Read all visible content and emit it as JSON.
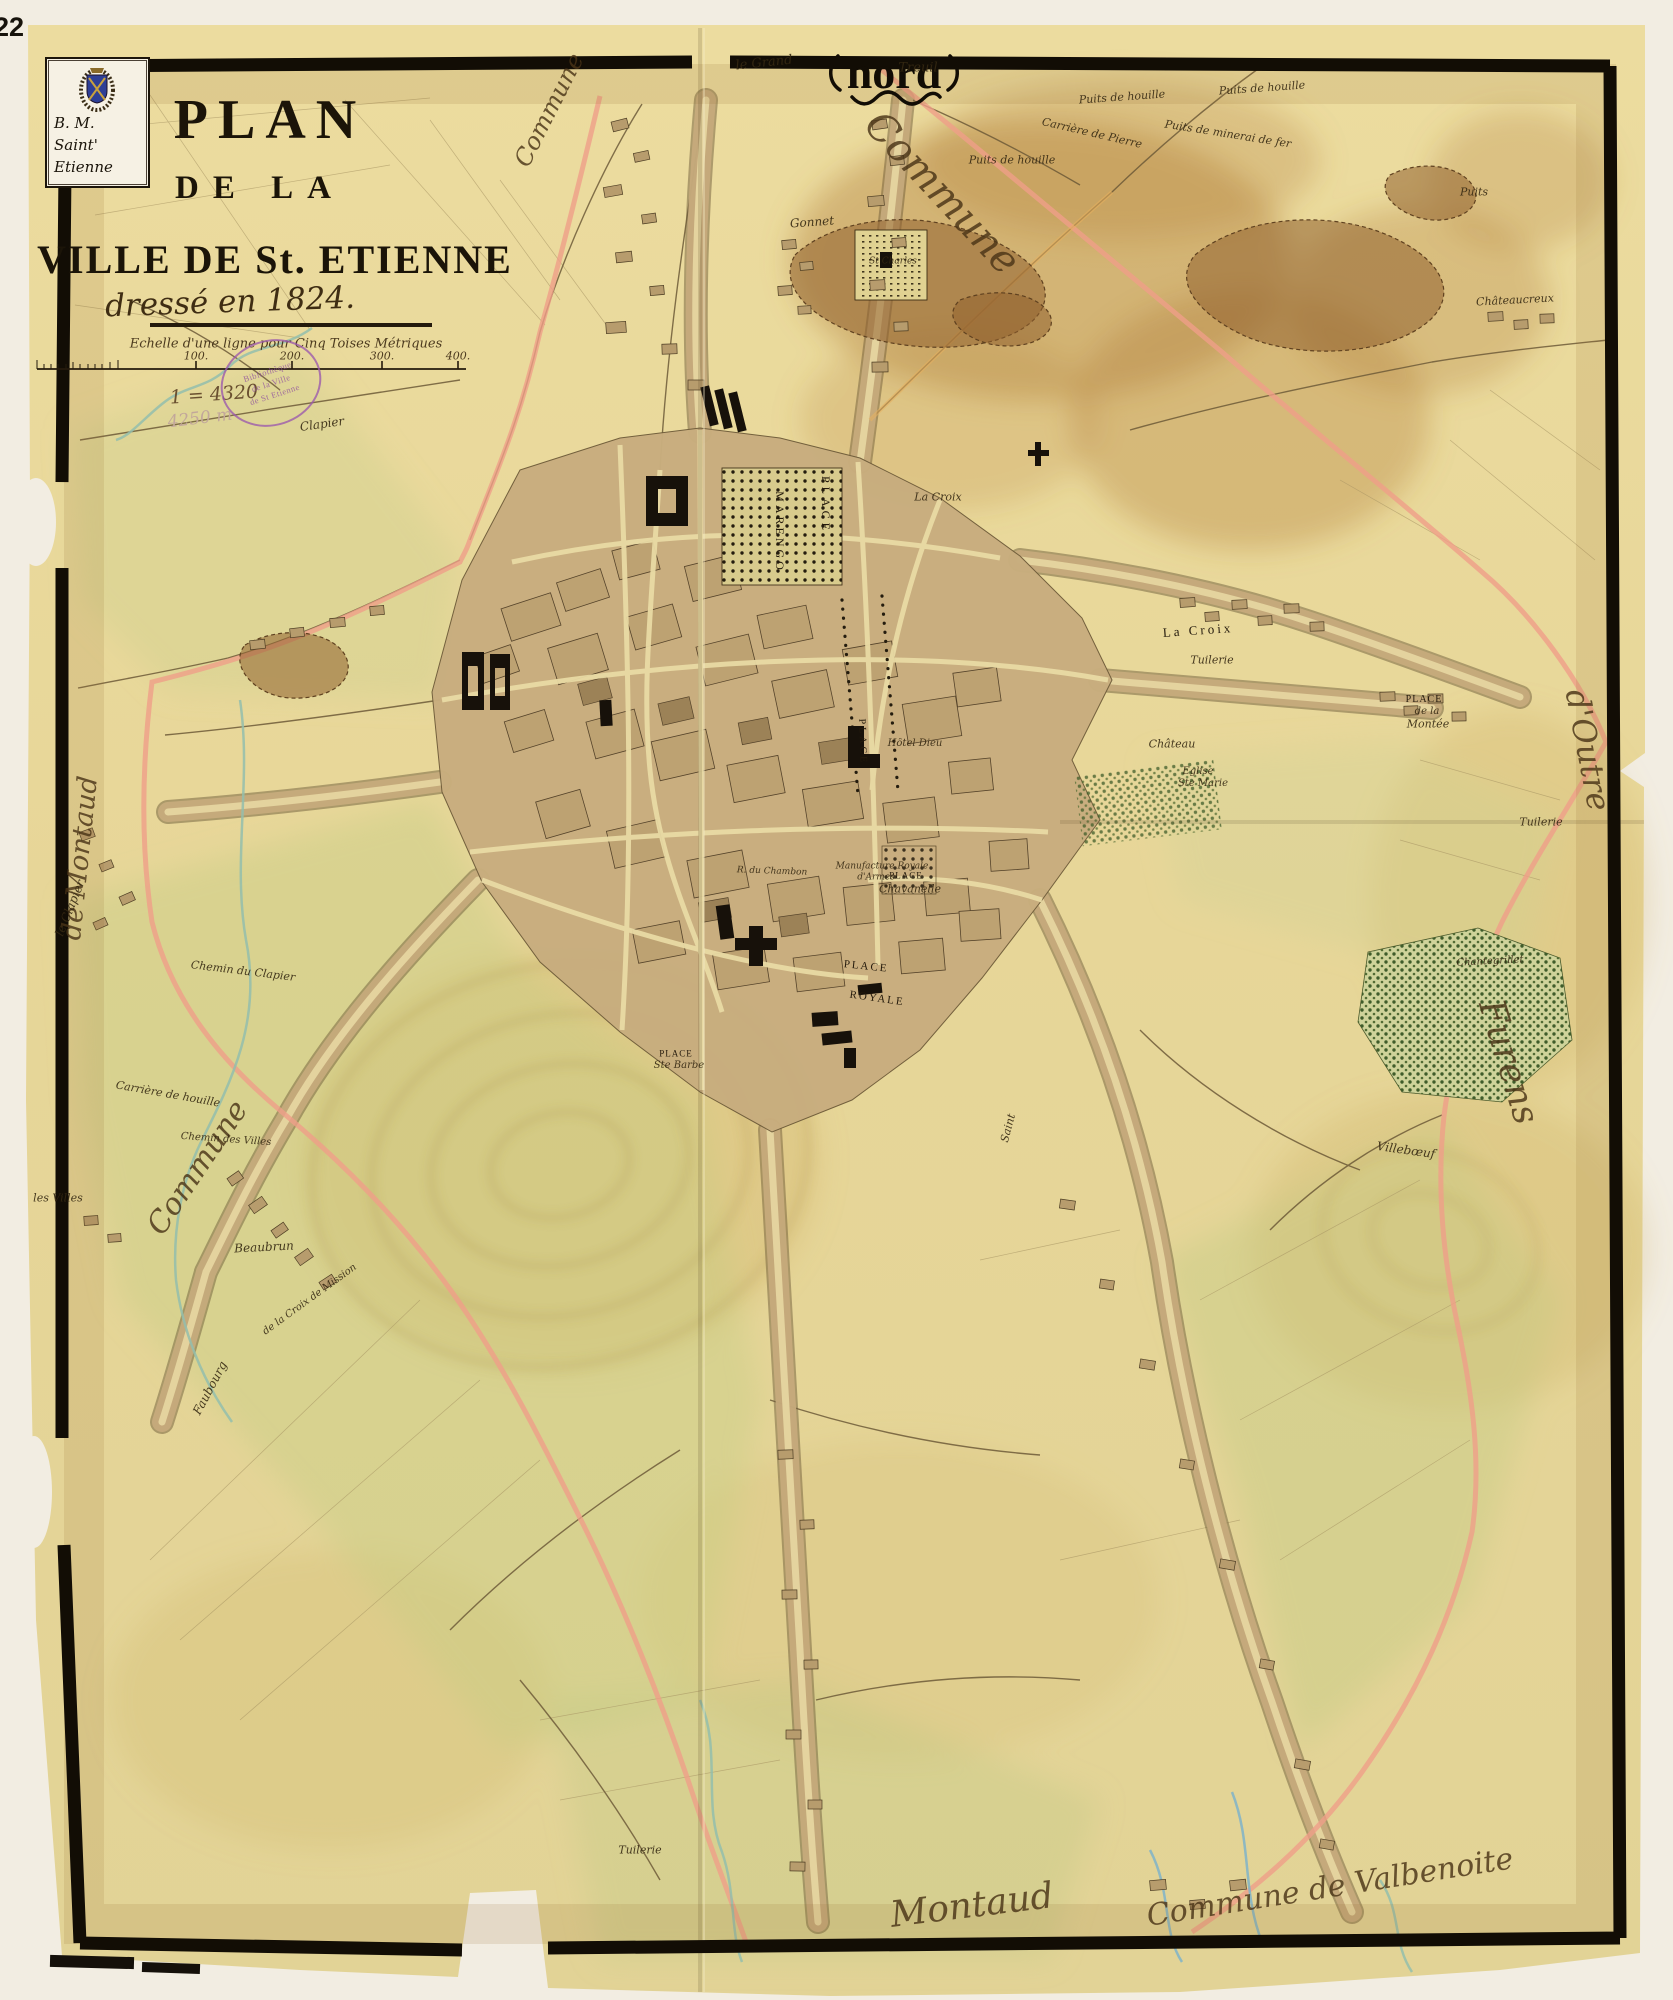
{
  "page": {
    "number": "22"
  },
  "title": {
    "line1": "PLAN",
    "line2": "DE LA",
    "line3": "VILLE DE St. ETIENNE",
    "subtitle": "dressé en 1824."
  },
  "bookplate": {
    "line1": "B.  M.",
    "line2": "Saint'",
    "line3": "Etienne",
    "emblem": "city-coat-of-arms"
  },
  "stamp": {
    "line1": "Bibliothèque",
    "line2": "de la Ville",
    "line3": "de St Etienne"
  },
  "colors": {
    "paper": "#e8d89b",
    "page_background": "#f2ede2",
    "frame_ink": "#120d05",
    "boundary_pink": "#ef9f88",
    "road_orange": "#e7b05e",
    "stream_green": "#93bead",
    "stain_brown": "#b07a38",
    "urban_tan": "#c8ad7e",
    "stamp_purple": "#9b59ad"
  },
  "map_labels": [
    {
      "text": "nord",
      "x": 894,
      "y": 73,
      "cls": "nord",
      "size": 46,
      "name": "north-label"
    },
    {
      "text": "Commune",
      "x": 942,
      "y": 193,
      "cls": "script-lg",
      "size": 40,
      "rot": 47,
      "name": "commune-label-ne"
    },
    {
      "text": "Commune",
      "x": 549,
      "y": 110,
      "cls": "script-md",
      "size": 24,
      "rot": -63,
      "name": "commune-label-n"
    },
    {
      "text": "le Grand",
      "x": 764,
      "y": 63,
      "cls": "small",
      "size": 13,
      "rot": -6
    },
    {
      "text": "Treuil",
      "x": 918,
      "y": 68,
      "cls": "small",
      "size": 13
    },
    {
      "text": "Puits de houille",
      "x": 1122,
      "y": 97,
      "cls": "small",
      "size": 11,
      "rot": -4
    },
    {
      "text": "Puits de houille",
      "x": 1012,
      "y": 160,
      "cls": "small",
      "size": 11
    },
    {
      "text": "Puits de houille",
      "x": 1262,
      "y": 88,
      "cls": "small",
      "size": 11,
      "rot": -4
    },
    {
      "text": "Puits",
      "x": 1474,
      "y": 192,
      "cls": "small",
      "size": 11
    },
    {
      "text": "Carrière de Pierre",
      "x": 1092,
      "y": 133,
      "cls": "small",
      "size": 11,
      "rot": 13
    },
    {
      "text": "Puits de minerai de fer",
      "x": 1228,
      "y": 134,
      "cls": "small",
      "size": 11,
      "rot": 9
    },
    {
      "text": "Gonnet",
      "x": 812,
      "y": 222,
      "cls": "small",
      "size": 12,
      "rot": -4
    },
    {
      "text": "Châteaucreux",
      "x": 1515,
      "y": 300,
      "cls": "small",
      "size": 11,
      "rot": -3
    },
    {
      "text": "St Charles",
      "x": 893,
      "y": 262,
      "cls": "small",
      "size": 9
    },
    {
      "text": "La Croix",
      "x": 938,
      "y": 497,
      "cls": "small",
      "size": 11
    },
    {
      "text": "La Croix",
      "x": 1198,
      "y": 630,
      "cls": "place",
      "size": 13,
      "rot": -4,
      "ls": 3
    },
    {
      "text": "PLACE",
      "x": 1424,
      "y": 700,
      "cls": "place",
      "size": 10,
      "ls": 1
    },
    {
      "text": "de la",
      "x": 1427,
      "y": 712,
      "cls": "small",
      "size": 10
    },
    {
      "text": "Montée",
      "x": 1428,
      "y": 724,
      "cls": "small",
      "size": 11
    },
    {
      "text": "Tuilerie",
      "x": 1541,
      "y": 822,
      "cls": "small",
      "size": 11
    },
    {
      "text": "Tuilerie",
      "x": 1212,
      "y": 660,
      "cls": "small",
      "size": 11
    },
    {
      "text": "Eglise",
      "x": 1198,
      "y": 772,
      "cls": "small",
      "size": 10
    },
    {
      "text": "Ste Marie",
      "x": 1203,
      "y": 784,
      "cls": "small",
      "size": 10
    },
    {
      "text": "d'Outre",
      "x": 1588,
      "y": 750,
      "cls": "script-lg",
      "size": 32,
      "rot": 79,
      "name": "outre-furens-label"
    },
    {
      "text": "Furens",
      "x": 1508,
      "y": 1062,
      "cls": "script-lg",
      "size": 36,
      "rot": 73,
      "name": "furens-label"
    },
    {
      "text": "Château",
      "x": 1172,
      "y": 744,
      "cls": "small",
      "size": 11
    },
    {
      "text": "Chantegrillet",
      "x": 1490,
      "y": 962,
      "cls": "small",
      "size": 10,
      "rot": -3
    },
    {
      "text": "Villebœuf",
      "x": 1406,
      "y": 1150,
      "cls": "small",
      "size": 12,
      "rot": 8
    },
    {
      "text": "PLACE",
      "x": 826,
      "y": 505,
      "cls": "place",
      "size": 12,
      "rot": 90,
      "ls": 4,
      "name": "place-marengo-label"
    },
    {
      "text": "MARENGO",
      "x": 780,
      "y": 532,
      "cls": "place",
      "size": 12,
      "rot": 90,
      "ls": 3,
      "name": "place-marengo-label"
    },
    {
      "text": "PLACE",
      "x": 862,
      "y": 742,
      "cls": "place",
      "size": 10,
      "rot": 88,
      "ls": 3
    },
    {
      "text": "PLACE",
      "x": 866,
      "y": 967,
      "cls": "place",
      "size": 11,
      "rot": 6,
      "ls": 2,
      "name": "place-royale-label"
    },
    {
      "text": "ROYALE",
      "x": 877,
      "y": 999,
      "cls": "place",
      "size": 11,
      "rot": 8,
      "ls": 2,
      "name": "place-royale-label"
    },
    {
      "text": "PLACE",
      "x": 676,
      "y": 1054,
      "cls": "place",
      "size": 9,
      "ls": 1
    },
    {
      "text": "Ste Barbe",
      "x": 679,
      "y": 1066,
      "cls": "small",
      "size": 10
    },
    {
      "text": "PLACE",
      "x": 906,
      "y": 876,
      "cls": "place",
      "size": 9,
      "ls": 1
    },
    {
      "text": "Chavanelle",
      "x": 910,
      "y": 889,
      "cls": "small",
      "size": 11
    },
    {
      "text": "Hôtel Dieu",
      "x": 915,
      "y": 744,
      "cls": "small",
      "size": 10
    },
    {
      "text": "Manufacture Royale",
      "x": 882,
      "y": 867,
      "cls": "small",
      "size": 9
    },
    {
      "text": "d'Armes",
      "x": 876,
      "y": 878,
      "cls": "small",
      "size": 9
    },
    {
      "text": "R. du Chambon",
      "x": 772,
      "y": 872,
      "cls": "small",
      "size": 9,
      "rot": 2
    },
    {
      "text": "de Montaud",
      "x": 80,
      "y": 858,
      "cls": "script-md",
      "size": 27,
      "rot": -84,
      "name": "montaud-label-w"
    },
    {
      "text": "Commune",
      "x": 198,
      "y": 1168,
      "cls": "script-md",
      "size": 30,
      "rot": -56,
      "name": "commune-label-w"
    },
    {
      "text": "le Clapier",
      "x": 70,
      "y": 908,
      "cls": "small",
      "size": 12,
      "rot": -68
    },
    {
      "text": "Clapier",
      "x": 322,
      "y": 424,
      "cls": "small",
      "size": 12,
      "rot": -8
    },
    {
      "text": "Chemin du Clapier",
      "x": 243,
      "y": 971,
      "cls": "small",
      "size": 11,
      "rot": 7
    },
    {
      "text": "Carrière de houille",
      "x": 168,
      "y": 1094,
      "cls": "small",
      "size": 11,
      "rot": 10
    },
    {
      "text": "les Villes",
      "x": 58,
      "y": 1198,
      "cls": "small",
      "size": 11
    },
    {
      "text": "Chemin des Villes",
      "x": 226,
      "y": 1140,
      "cls": "small",
      "size": 10,
      "rot": 4
    },
    {
      "text": "Beaubrun",
      "x": 264,
      "y": 1247,
      "cls": "small",
      "size": 12,
      "rot": -3
    },
    {
      "text": "Faubourg",
      "x": 210,
      "y": 1388,
      "cls": "small",
      "size": 12,
      "rot": -62
    },
    {
      "text": "de la Croix de Mission",
      "x": 310,
      "y": 1300,
      "cls": "small",
      "size": 10,
      "rot": -36
    },
    {
      "text": "Saint",
      "x": 1008,
      "y": 1128,
      "cls": "small",
      "size": 11,
      "rot": -75
    },
    {
      "text": "Tuilerie",
      "x": 640,
      "y": 1850,
      "cls": "small",
      "size": 11
    },
    {
      "text": "Montaud",
      "x": 972,
      "y": 1906,
      "cls": "script-lg",
      "size": 36,
      "rot": -7,
      "name": "montaud-label-s"
    },
    {
      "text": "Commune de Valbenoite",
      "x": 1330,
      "y": 1888,
      "cls": "script-lg",
      "size": 30,
      "rot": -9,
      "name": "valbenoite-label"
    },
    {
      "text": "Echelle d'une ligne pour Cinq Toises Métriques",
      "x": 286,
      "y": 344,
      "cls": "hand",
      "size": 13,
      "name": "scale-caption"
    },
    {
      "text": "100.",
      "x": 196,
      "y": 356,
      "cls": "hand",
      "size": 11,
      "name": "scale-tick-label"
    },
    {
      "text": "200.",
      "x": 292,
      "y": 356,
      "cls": "hand",
      "size": 11,
      "name": "scale-tick-label"
    },
    {
      "text": "300.",
      "x": 382,
      "y": 356,
      "cls": "hand",
      "size": 11,
      "name": "scale-tick-label"
    },
    {
      "text": "400.",
      "x": 458,
      "y": 356,
      "cls": "hand",
      "size": 11,
      "name": "scale-tick-label"
    },
    {
      "text": "1 = 4320",
      "x": 214,
      "y": 395,
      "cls": "hand",
      "size": 19,
      "rot": -4,
      "color": "#6a5030",
      "name": "pencil-note"
    },
    {
      "text": "4250 m",
      "x": 200,
      "y": 419,
      "cls": "hand",
      "size": 17,
      "rot": -7,
      "color": "#c2a79b",
      "name": "pencil-note"
    }
  ]
}
